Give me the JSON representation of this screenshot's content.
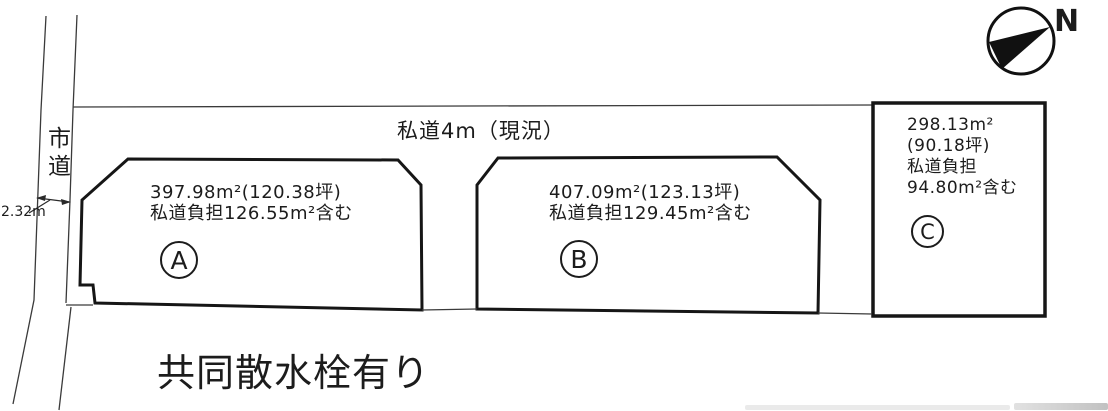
{
  "compass": {
    "north_label": "N"
  },
  "roads": {
    "city_road_label": "市道",
    "city_road_width": "2.32m",
    "private_road_label": "私道4m（現況）"
  },
  "plots": [
    {
      "id": "A",
      "area": "397.98m²(120.38坪)",
      "road_burden": "私道負担126.55m²含む"
    },
    {
      "id": "B",
      "area": "407.09m²(123.13坪)",
      "road_burden": "私道負担129.45m²含む"
    },
    {
      "id": "C",
      "area_line1": "298.13m²",
      "area_line2": "(90.18坪)",
      "burden_line1": "私道負担",
      "burden_line2": "94.80m²含む"
    }
  ],
  "note": {
    "text": "共同散水栓有り"
  }
}
